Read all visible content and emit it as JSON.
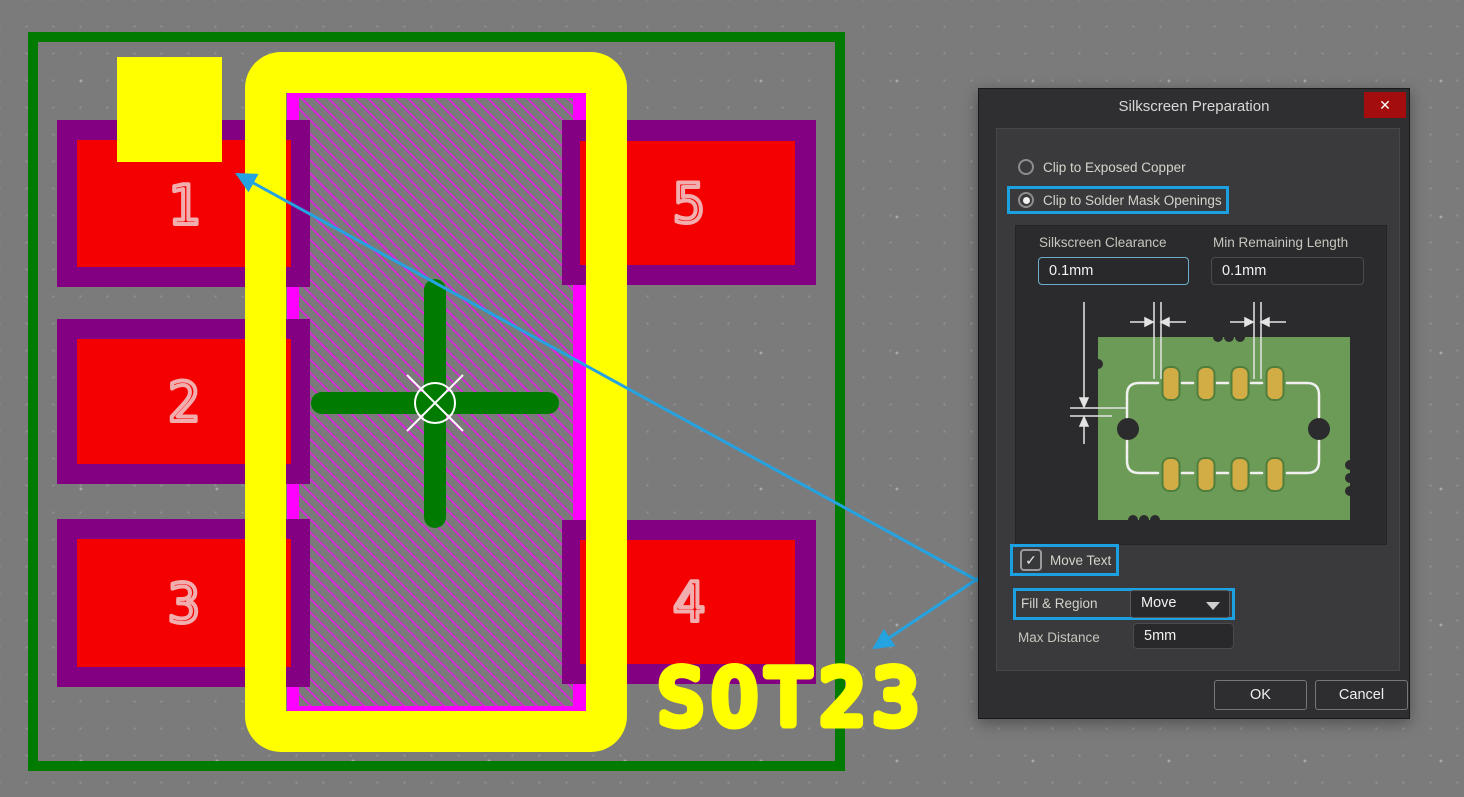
{
  "canvas": {
    "footprint_name": "SOT23",
    "pads": [
      {
        "label": "1"
      },
      {
        "label": "2"
      },
      {
        "label": "3"
      },
      {
        "label": "4"
      },
      {
        "label": "5"
      }
    ],
    "colors": {
      "background": "#7b7b7b",
      "courtyard_green": "#007b00",
      "pad_outer_purple": "#830083",
      "pad_inner_red": "#f40000",
      "solder_mask_magenta": "#ff00ff",
      "silkscreen_yellow": "#ffff00",
      "hatch_stripe": "#da26da",
      "pad_number_pink": "#f2aeae",
      "arrow_blue": "#25a3e1"
    }
  },
  "dialog": {
    "title": "Silkscreen Preparation",
    "close_icon": "✕",
    "radio_options": [
      {
        "label": "Clip to Exposed Copper",
        "selected": false
      },
      {
        "label": "Clip to Solder Mask Openings",
        "selected": true
      }
    ],
    "silkscreen_clearance": {
      "label": "Silkscreen Clearance",
      "value": "0.1mm"
    },
    "min_remaining_length": {
      "label": "Min Remaining Length",
      "value": "0.1mm"
    },
    "move_text": {
      "label": "Move Text",
      "checked": true,
      "check_icon": "✓"
    },
    "fill_region": {
      "label": "Fill & Region",
      "value": "Move"
    },
    "max_distance": {
      "label": "Max Distance",
      "value": "5mm"
    },
    "buttons": {
      "ok": "OK",
      "cancel": "Cancel"
    },
    "highlight_color": "#1ba1e2"
  }
}
